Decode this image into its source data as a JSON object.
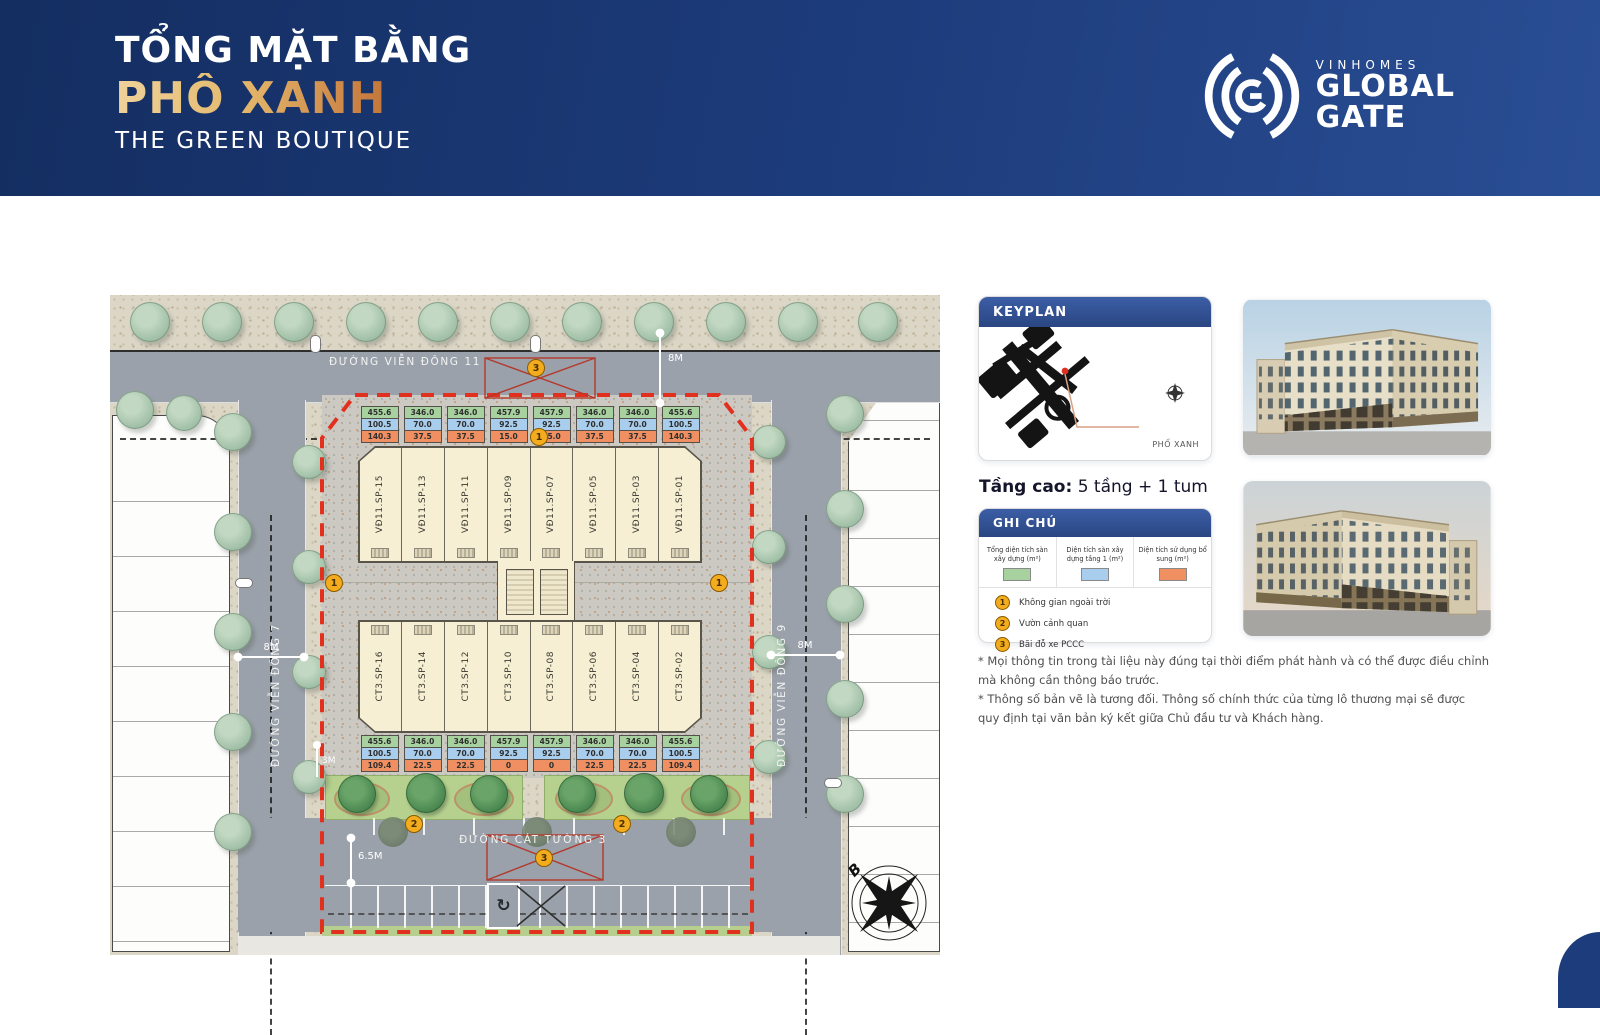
{
  "header": {
    "title_line1": "TỔNG MẶT BẰNG",
    "title_line2": "PHỐ XANH",
    "title_line3": "THE GREEN BOUTIQUE",
    "brand": {
      "name": "VINHOMES",
      "big1": "GLOBAL",
      "big2": "GATE"
    }
  },
  "plan": {
    "street_top": "ĐƯỜNG VIỄN ĐÔNG 11",
    "street_left": "ĐƯỜNG VIỄN ĐÔNG 7",
    "street_right": "ĐƯỜNG VIỄN ĐÔNG 9",
    "street_bottom": "ĐƯỜNG CÁT TƯỜNG 3",
    "dim_top": "8M",
    "dim_left": "8M",
    "dim_right": "8M",
    "dim_setback": "3M",
    "dim_bottom": "6.5M",
    "compass_north": "B",
    "marker_open_space": "1",
    "marker_garden": "2",
    "marker_parking": "3",
    "top_units": [
      {
        "label": "VĐ11.SP-15",
        "total": "455.6",
        "floor1": "100.5",
        "extra": "140.3"
      },
      {
        "label": "VĐ11.SP-13",
        "total": "346.0",
        "floor1": "70.0",
        "extra": "37.5"
      },
      {
        "label": "VĐ11.SP-11",
        "total": "346.0",
        "floor1": "70.0",
        "extra": "37.5"
      },
      {
        "label": "VĐ11.SP-09",
        "total": "457.9",
        "floor1": "92.5",
        "extra": "15.0"
      },
      {
        "label": "VĐ11.SP-07",
        "total": "457.9",
        "floor1": "92.5",
        "extra": "15.0"
      },
      {
        "label": "VĐ11.SP-05",
        "total": "346.0",
        "floor1": "70.0",
        "extra": "37.5"
      },
      {
        "label": "VĐ11.SP-03",
        "total": "346.0",
        "floor1": "70.0",
        "extra": "37.5"
      },
      {
        "label": "VĐ11.SP-01",
        "total": "455.6",
        "floor1": "100.5",
        "extra": "140.3"
      }
    ],
    "bottom_units": [
      {
        "label": "CT3.SP-16",
        "total": "455.6",
        "floor1": "100.5",
        "extra": "109.4"
      },
      {
        "label": "CT3.SP-14",
        "total": "346.0",
        "floor1": "70.0",
        "extra": "22.5"
      },
      {
        "label": "CT3.SP-12",
        "total": "346.0",
        "floor1": "70.0",
        "extra": "22.5"
      },
      {
        "label": "CT3.SP-10",
        "total": "457.9",
        "floor1": "92.5",
        "extra": "0"
      },
      {
        "label": "CT3.SP-08",
        "total": "457.9",
        "floor1": "92.5",
        "extra": "0"
      },
      {
        "label": "CT3.SP-06",
        "total": "346.0",
        "floor1": "70.0",
        "extra": "22.5"
      },
      {
        "label": "CT3.SP-04",
        "total": "346.0",
        "floor1": "70.0",
        "extra": "22.5"
      },
      {
        "label": "CT3.SP-02",
        "total": "455.6",
        "floor1": "100.5",
        "extra": "109.4"
      }
    ]
  },
  "sidebar": {
    "keyplan_title": "KEYPLAN",
    "keyplan_location": "PHỐ XANH",
    "floors_label": "Tầng cao:",
    "floors_value": " 5 tầng + 1 tum",
    "legend_title": "GHI CHÚ",
    "legend_swatches": [
      {
        "label": "Tổng diện tích sàn xây dựng (m²)",
        "color": "#a7d29f"
      },
      {
        "label": "Diện tích sàn xây dựng tầng 1 (m²)",
        "color": "#a9cdec"
      },
      {
        "label": "Diện tích sử dụng bổ sung (m²)",
        "color": "#f09062"
      }
    ],
    "legend_items": [
      {
        "num": "1",
        "label": "Không gian ngoài trời"
      },
      {
        "num": "2",
        "label": "Vườn cảnh quan"
      },
      {
        "num": "3",
        "label": "Bãi đỗ xe PCCC"
      }
    ],
    "disclaimer_1": "* Mọi thông tin trong tài liệu này đúng tại thời điểm phát hành và có thể được điều chỉnh mà không cần thông báo trước.",
    "disclaimer_2": "* Thông số bản vẽ là tương đối. Thông số chính thức của từng lô thương mại sẽ được quy định tại văn bản ký kết giữa Chủ đầu tư và Khách hàng."
  },
  "colors": {
    "header_blue": "#1d3c7c",
    "accent_gold": "#d9a85c",
    "legend_green": "#a7d29f",
    "legend_blue": "#a9cdec",
    "legend_orange": "#f09062",
    "boundary_red": "#e2301f",
    "marker_yellow": "#f3ac1d"
  }
}
